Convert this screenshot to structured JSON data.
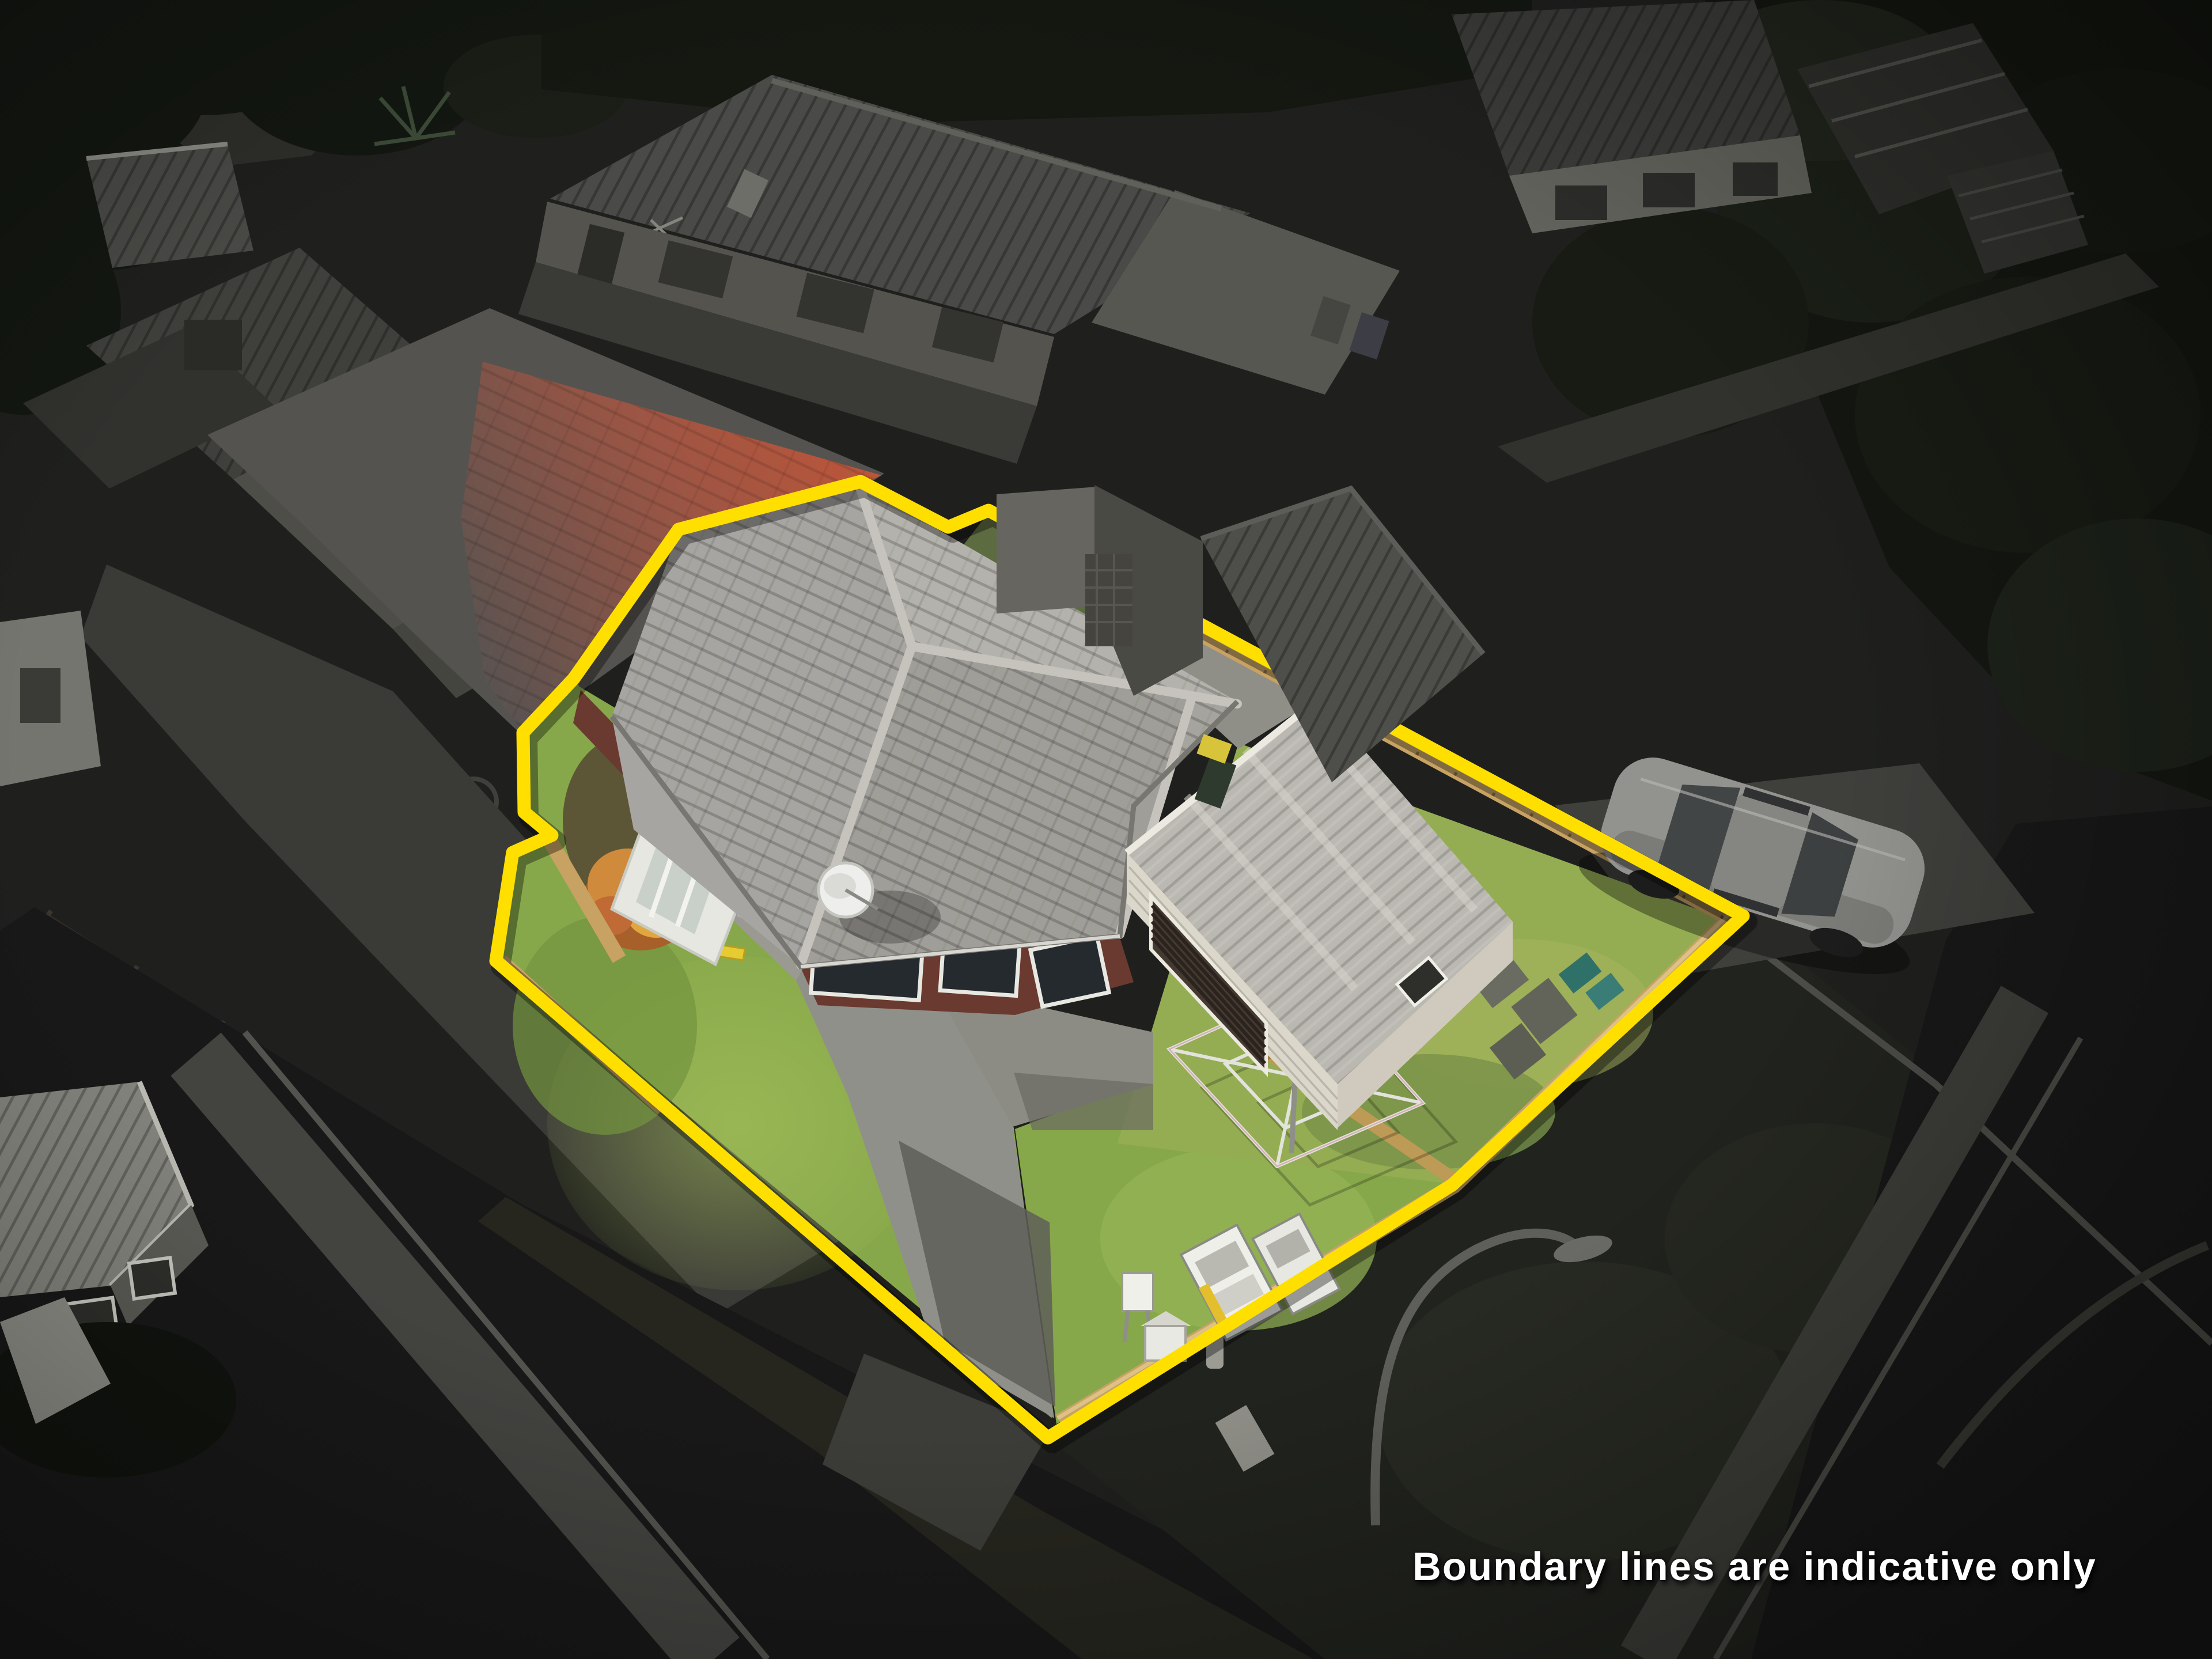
{
  "caption": {
    "text": "Boundary lines are indicative only"
  },
  "boundary": {
    "type": "property-boundary-polygon",
    "color": "#ffdf00",
    "style": "solid thick line with notch at top and step on left side"
  },
  "palette": {
    "yellow": "#ffdf00",
    "caption": "#ffffff",
    "bg": "#1d1e1c",
    "road": "#181818",
    "lawn": "#87a84a",
    "tile": "#a7a5a1",
    "brick": "#6a392f",
    "fence": "#c7a263",
    "garageWall": "#dbd7cb",
    "redRoof": "#b05038",
    "car": "#92938f"
  },
  "scene": {
    "type": "aerial-drone-photo",
    "highlighted_property": [
      "hip-roof-house",
      "garage",
      "front-lawn",
      "backyard-lawn",
      "driveway",
      "rotary-clothesline",
      "timber-fences",
      "satellite-dish"
    ],
    "outside_property": [
      "neighbour-duplex-unit",
      "rear-neighbour-house",
      "street",
      "footpath",
      "parked-car",
      "street-light",
      "hedges"
    ]
  }
}
